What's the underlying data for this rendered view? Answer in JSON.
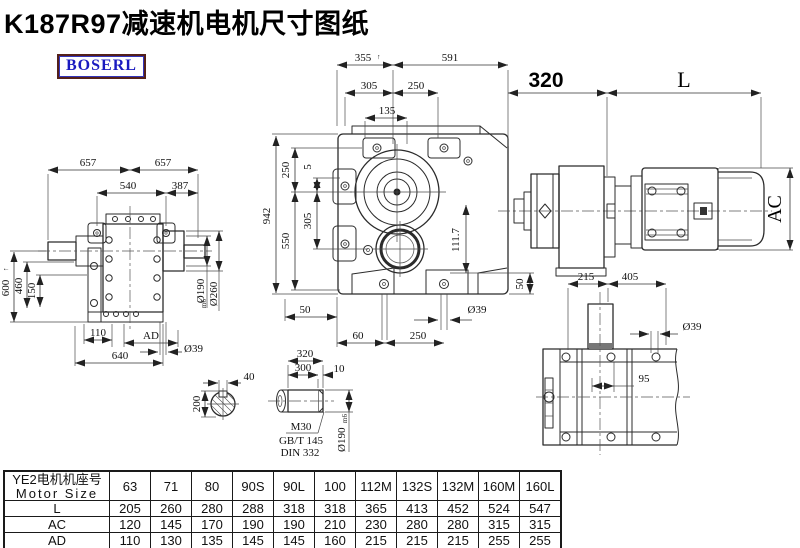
{
  "title": "K187R97减速机电机尺寸图纸",
  "logo": "BOSERL",
  "colors": {
    "line": "#2b2b2b",
    "logo_text": "#1a1ac0",
    "logo_border": "#54201a"
  },
  "dims": {
    "side": {
      "d657a": "657",
      "d657b": "657",
      "d540": "540",
      "d387": "387",
      "d600": "600",
      "d600mark": "↑",
      "d460": "460",
      "d150": "150",
      "d110": "110",
      "dAD": "AD",
      "d640": "640",
      "dia39": "Ø39",
      "dia190": "Ø190",
      "dia190tol": "m6",
      "dia260": "Ø260"
    },
    "front": {
      "d355": "355",
      "d355mark": "↑",
      "d591": "591",
      "d305t": "305",
      "d250t": "250",
      "d135": "135",
      "d250l": "250",
      "d5": "5",
      "d305l": "305",
      "d550": "550",
      "d942": "942",
      "d50a": "50",
      "d60": "60",
      "d250b": "250",
      "dia39": "Ø39",
      "d50b": "50",
      "d111": "111.7"
    },
    "assembly": {
      "d320": "320",
      "dL": "L",
      "dAC": "AC"
    },
    "top": {
      "d215": "215",
      "d405": "405",
      "dia39": "Ø39",
      "d95": "95"
    },
    "section": {
      "d40": "40",
      "d200": "200"
    },
    "shaft": {
      "d320": "320",
      "d300": "300",
      "d10": "10",
      "m30": "M30",
      "gbt": "GB/T 145",
      "din": "DIN 332",
      "dia190": "Ø190",
      "dia190tol": "m6"
    }
  },
  "table": {
    "header_cn": "YE2电机机座号",
    "header_en": "Motor Size",
    "columns": [
      "63",
      "71",
      "80",
      "90S",
      "90L",
      "100",
      "112M",
      "132S",
      "132M",
      "160M",
      "160L"
    ],
    "rows": [
      {
        "label": "L",
        "values": [
          "205",
          "260",
          "280",
          "288",
          "318",
          "318",
          "365",
          "413",
          "452",
          "524",
          "547"
        ]
      },
      {
        "label": "AC",
        "values": [
          "120",
          "145",
          "170",
          "190",
          "190",
          "210",
          "230",
          "280",
          "280",
          "315",
          "315"
        ]
      },
      {
        "label": "AD",
        "values": [
          "110",
          "130",
          "135",
          "145",
          "145",
          "160",
          "215",
          "215",
          "215",
          "255",
          "255"
        ]
      }
    ]
  }
}
